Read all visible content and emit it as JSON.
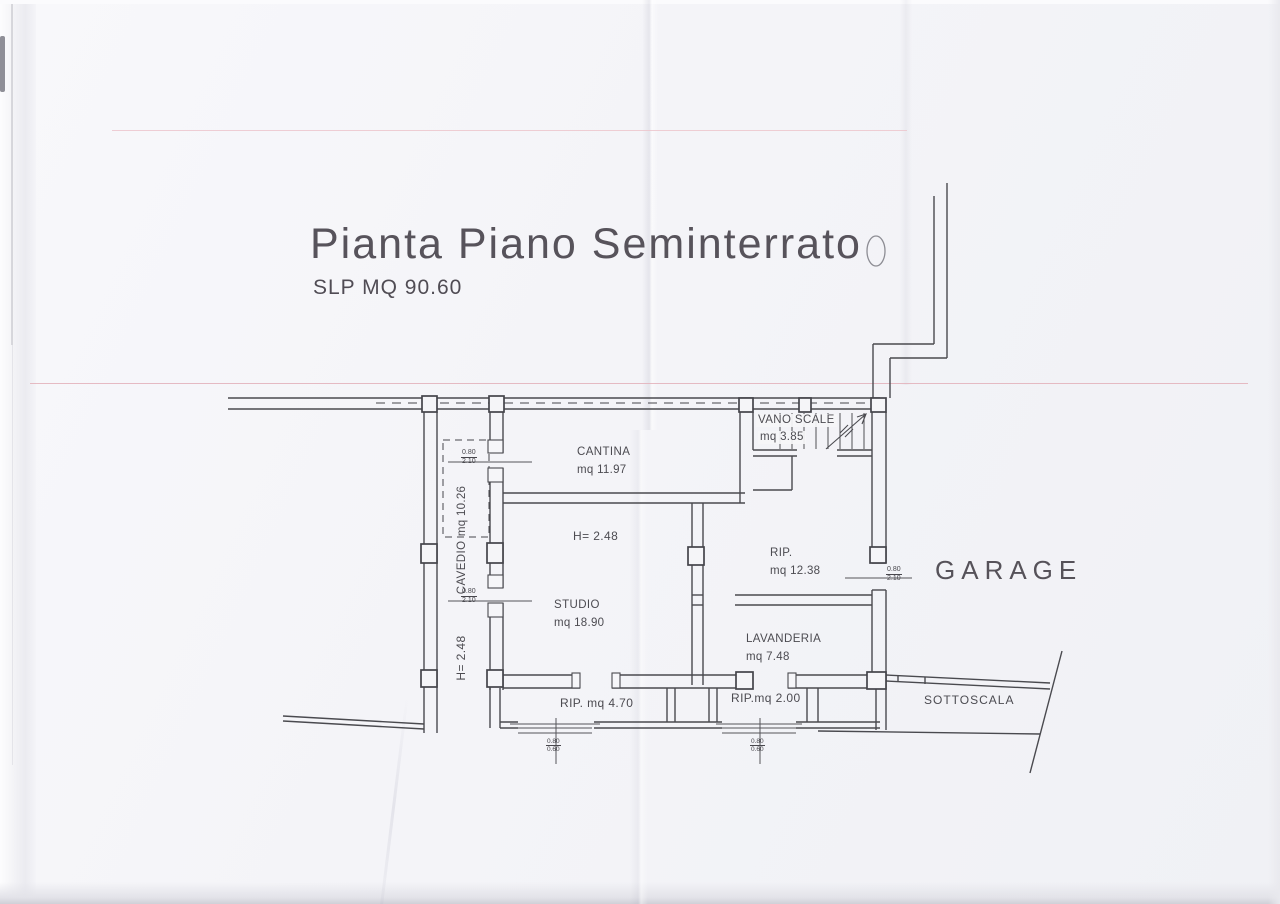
{
  "document": {
    "title": "Pianta Piano Seminterrato",
    "subtitle": "SLP MQ 90.60"
  },
  "rooms": {
    "cantina": {
      "name": "CANTINA",
      "area": "mq 11.97"
    },
    "vano_scale": {
      "name": "VANO SCALE",
      "area": "mq 3.85"
    },
    "cavedio": {
      "name": "CAVEDIO",
      "area": "mq 10.26"
    },
    "studio": {
      "name": "STUDIO",
      "area": "mq 18.90"
    },
    "ripostiglio": {
      "name": "RIP.",
      "area": "mq 12.38"
    },
    "lavanderia": {
      "name": "LAVANDERIA",
      "area": "mq 7.48"
    },
    "rip_sinistro": {
      "label": "RIP. mq 4.70"
    },
    "rip_destro": {
      "label": "RIP.mq 2.00"
    },
    "garage": {
      "label": "GARAGE"
    },
    "sottoscala": {
      "label": "SOTTOSCALA"
    }
  },
  "heights": {
    "studio": "H= 2.48",
    "cavedio": "H= 2.48"
  },
  "dimensions": {
    "door": {
      "width": "0.80",
      "height": "2.10"
    },
    "window": {
      "width": "0.80",
      "height": "0.60"
    }
  },
  "colors": {
    "ink": "#4a4a4f",
    "scan_line": "#e3b4bd",
    "paper": "#f4f4f8"
  }
}
